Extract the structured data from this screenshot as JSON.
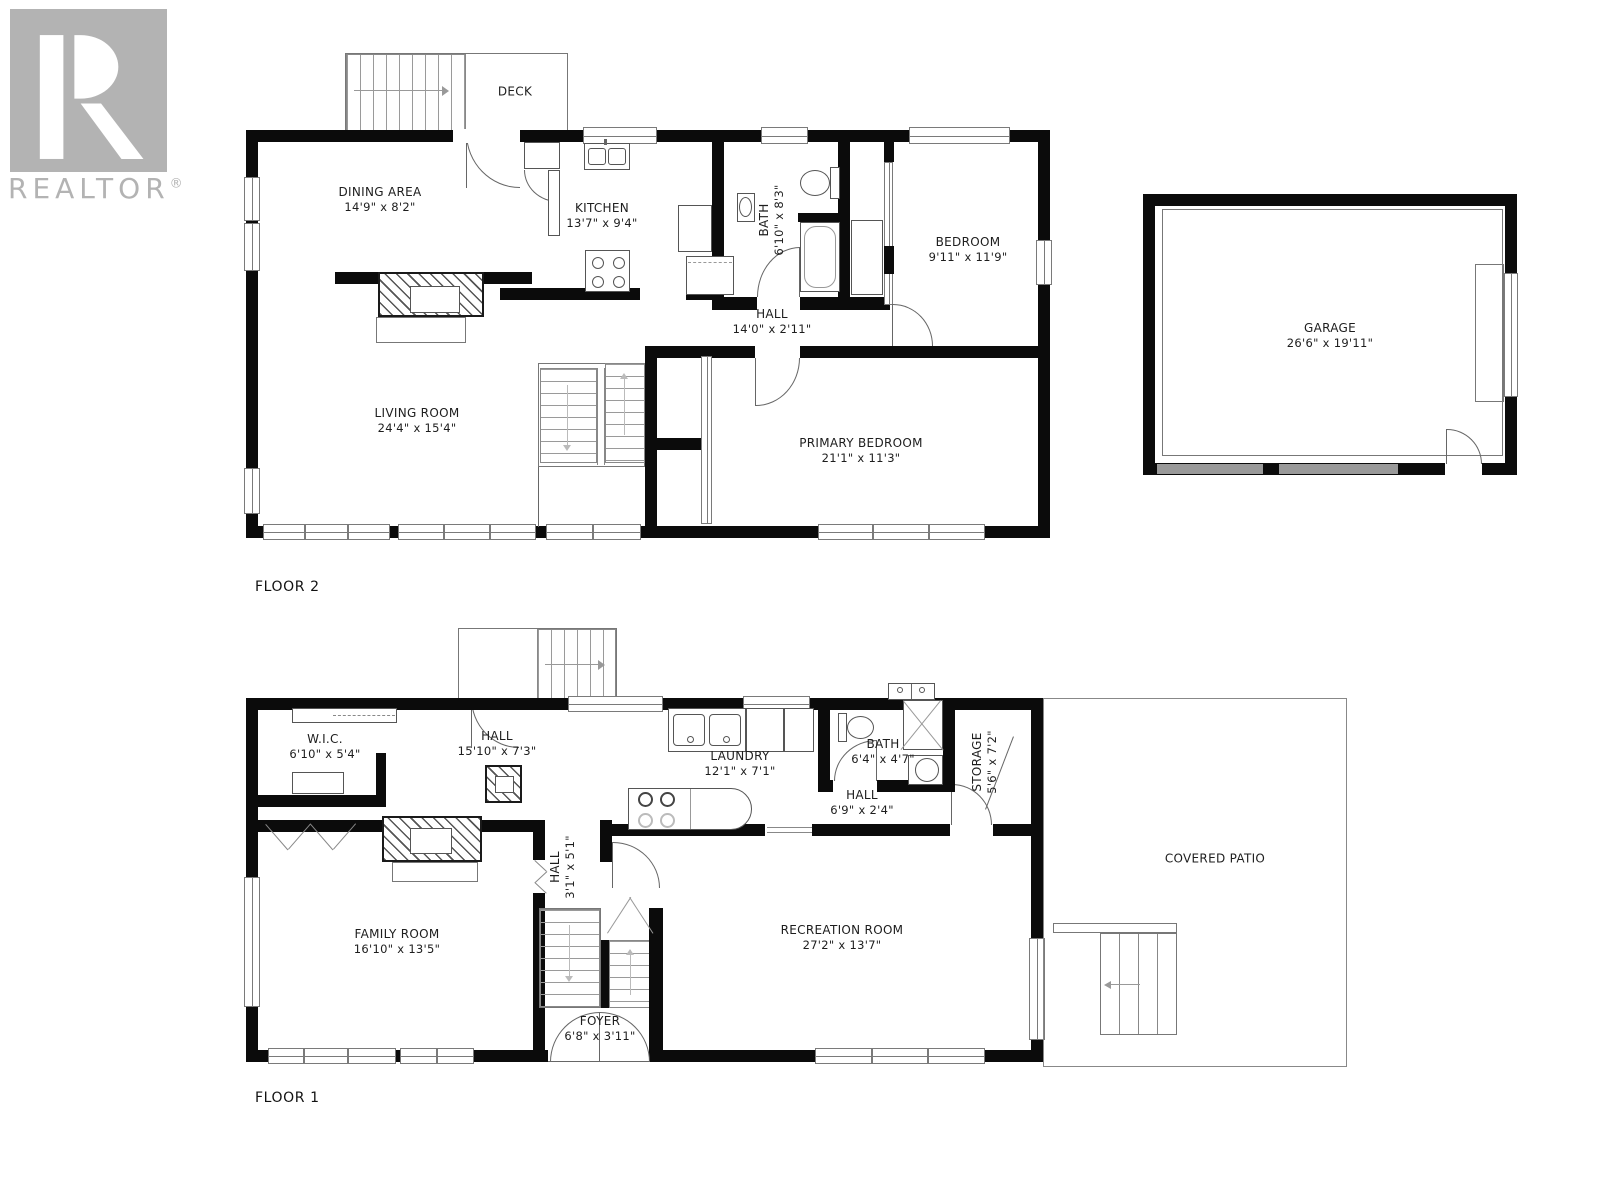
{
  "branding": {
    "name": "REALTOR",
    "reg": "®",
    "logo_color": "#b3b3b3"
  },
  "colors": {
    "wall": "#0b0b0b",
    "thin_line": "#666666",
    "garage_door": "#999999"
  },
  "floor2": {
    "label": "FLOOR 2",
    "rooms": [
      {
        "name": "DECK",
        "dims": ""
      },
      {
        "name": "DINING AREA",
        "dims": "14'9\" x 8'2\""
      },
      {
        "name": "KITCHEN",
        "dims": "13'7\" x 9'4\""
      },
      {
        "name": "BATH",
        "dims": "6'10\" x 8'3\""
      },
      {
        "name": "BEDROOM",
        "dims": "9'11\" x 11'9\""
      },
      {
        "name": "HALL",
        "dims": "14'0\" x 2'11\""
      },
      {
        "name": "LIVING ROOM",
        "dims": "24'4\" x 15'4\""
      },
      {
        "name": "PRIMARY BEDROOM",
        "dims": "21'1\" x 11'3\""
      },
      {
        "name": "GARAGE",
        "dims": "26'6\" x 19'11\""
      }
    ]
  },
  "floor1": {
    "label": "FLOOR 1",
    "rooms": [
      {
        "name": "W.I.C.",
        "dims": "6'10\" x 5'4\""
      },
      {
        "name": "HALL",
        "dims": "15'10\" x 7'3\""
      },
      {
        "name": "LAUNDRY",
        "dims": "12'1\" x 7'1\""
      },
      {
        "name": "BATH",
        "dims": "6'4\" x 4'7\""
      },
      {
        "name": "STORAGE",
        "dims": "5'6\" x 7'2\""
      },
      {
        "name": "HALL",
        "dims": "6'9\" x 2'4\""
      },
      {
        "name": "HALL",
        "dims": "3'1\" x 5'1\""
      },
      {
        "name": "FAMILY ROOM",
        "dims": "16'10\" x 13'5\""
      },
      {
        "name": "RECREATION ROOM",
        "dims": "27'2\" x 13'7\""
      },
      {
        "name": "FOYER",
        "dims": "6'8\" x 3'11\""
      },
      {
        "name": "COVERED PATIO",
        "dims": ""
      }
    ]
  }
}
